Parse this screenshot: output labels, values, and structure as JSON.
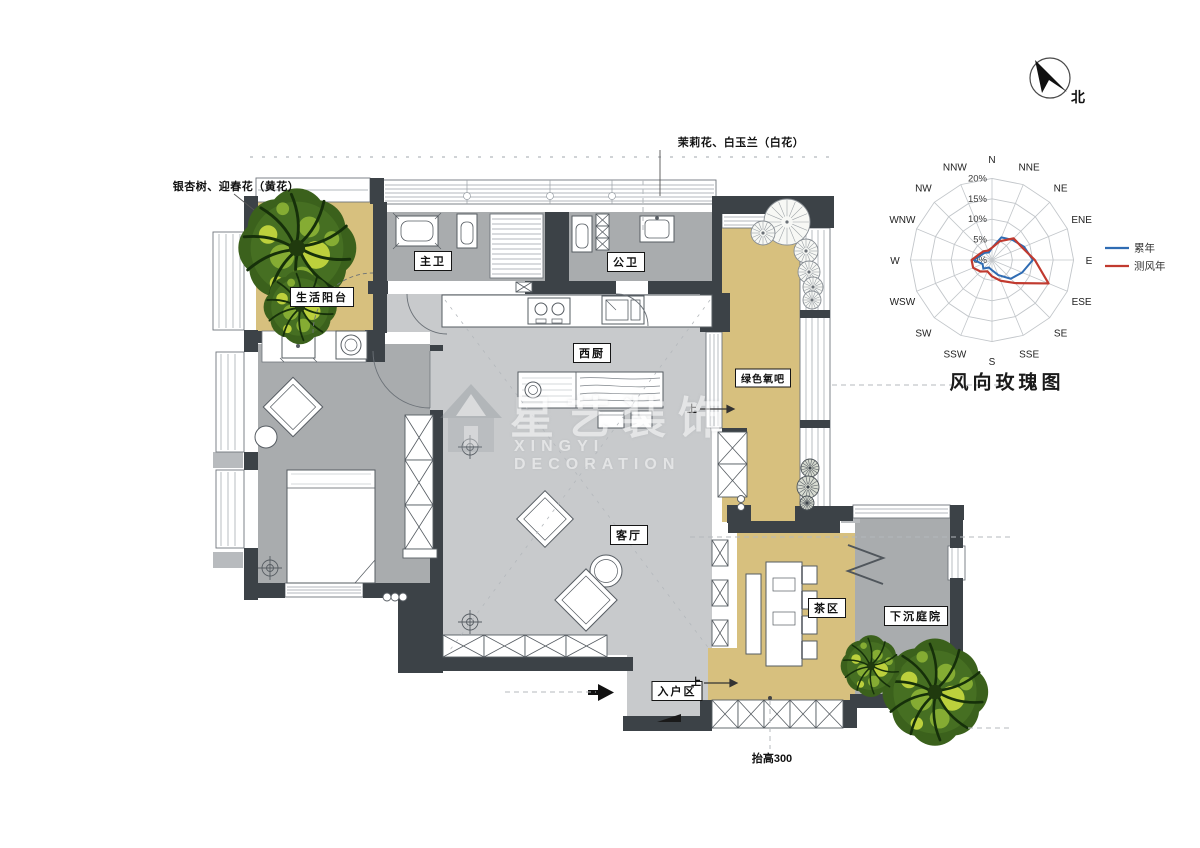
{
  "north_indicator": {
    "label": "北"
  },
  "plan_labels": {
    "life_balcony": "生活阳台",
    "master_bath": "主卫",
    "public_bath": "公卫",
    "west_kitchen": "西厨",
    "green_oxygen_bar": "绿色氧吧",
    "living_room": "客厅",
    "tea_area": "茶区",
    "sunken_courtyard": "下沉庭院",
    "entry_area": "入户区"
  },
  "annotations": {
    "planting_yellow": "银杏树、迎春花（黄花）",
    "planting_white": "茉莉花、白玉兰（白花）",
    "floor_raise": "抬高300",
    "stairs_up_kitchen": "上",
    "stairs_up_entry": "上"
  },
  "wind_rose": {
    "title": "风向玫瑰图"
  },
  "chart_data": {
    "type": "line",
    "polar": true,
    "title": "风向玫瑰图",
    "categories": [
      "N",
      "NNE",
      "NE",
      "ENE",
      "E",
      "ESE",
      "SE",
      "SSE",
      "S",
      "SSW",
      "SW",
      "WSW",
      "W",
      "WNW",
      "NW",
      "NNW"
    ],
    "rings_pct": [
      0,
      5,
      10,
      15,
      20
    ],
    "ring_labels": [
      "0%",
      "5%",
      "10%",
      "15%",
      "20%"
    ],
    "series": [
      {
        "name": "累年",
        "color": "#2F6CB3",
        "values": [
          3,
          6,
          7,
          8.5,
          10,
          8,
          6.5,
          4,
          2.5,
          2,
          3,
          2.5,
          4.5,
          3,
          2.5,
          2
        ]
      },
      {
        "name": "测风年",
        "color": "#C13A2F",
        "values": [
          3,
          5,
          7.5,
          8,
          10.5,
          15,
          8,
          5.5,
          4,
          3,
          4,
          5,
          5,
          3.5,
          3,
          2.5
        ]
      }
    ],
    "legend_position": "right",
    "grid": true
  },
  "watermark": {
    "cn": "星艺装饰",
    "en": "XINGYI DECORATION"
  },
  "colors": {
    "floor_tan": "#D7C07E",
    "floor_gray": "#A9ACAE",
    "floor_light": "#C8CACC",
    "wall": "#3C4247",
    "tree_green": "#3B611C",
    "series_cumulative": "#2F6CB3",
    "series_survey": "#C13A2F"
  }
}
